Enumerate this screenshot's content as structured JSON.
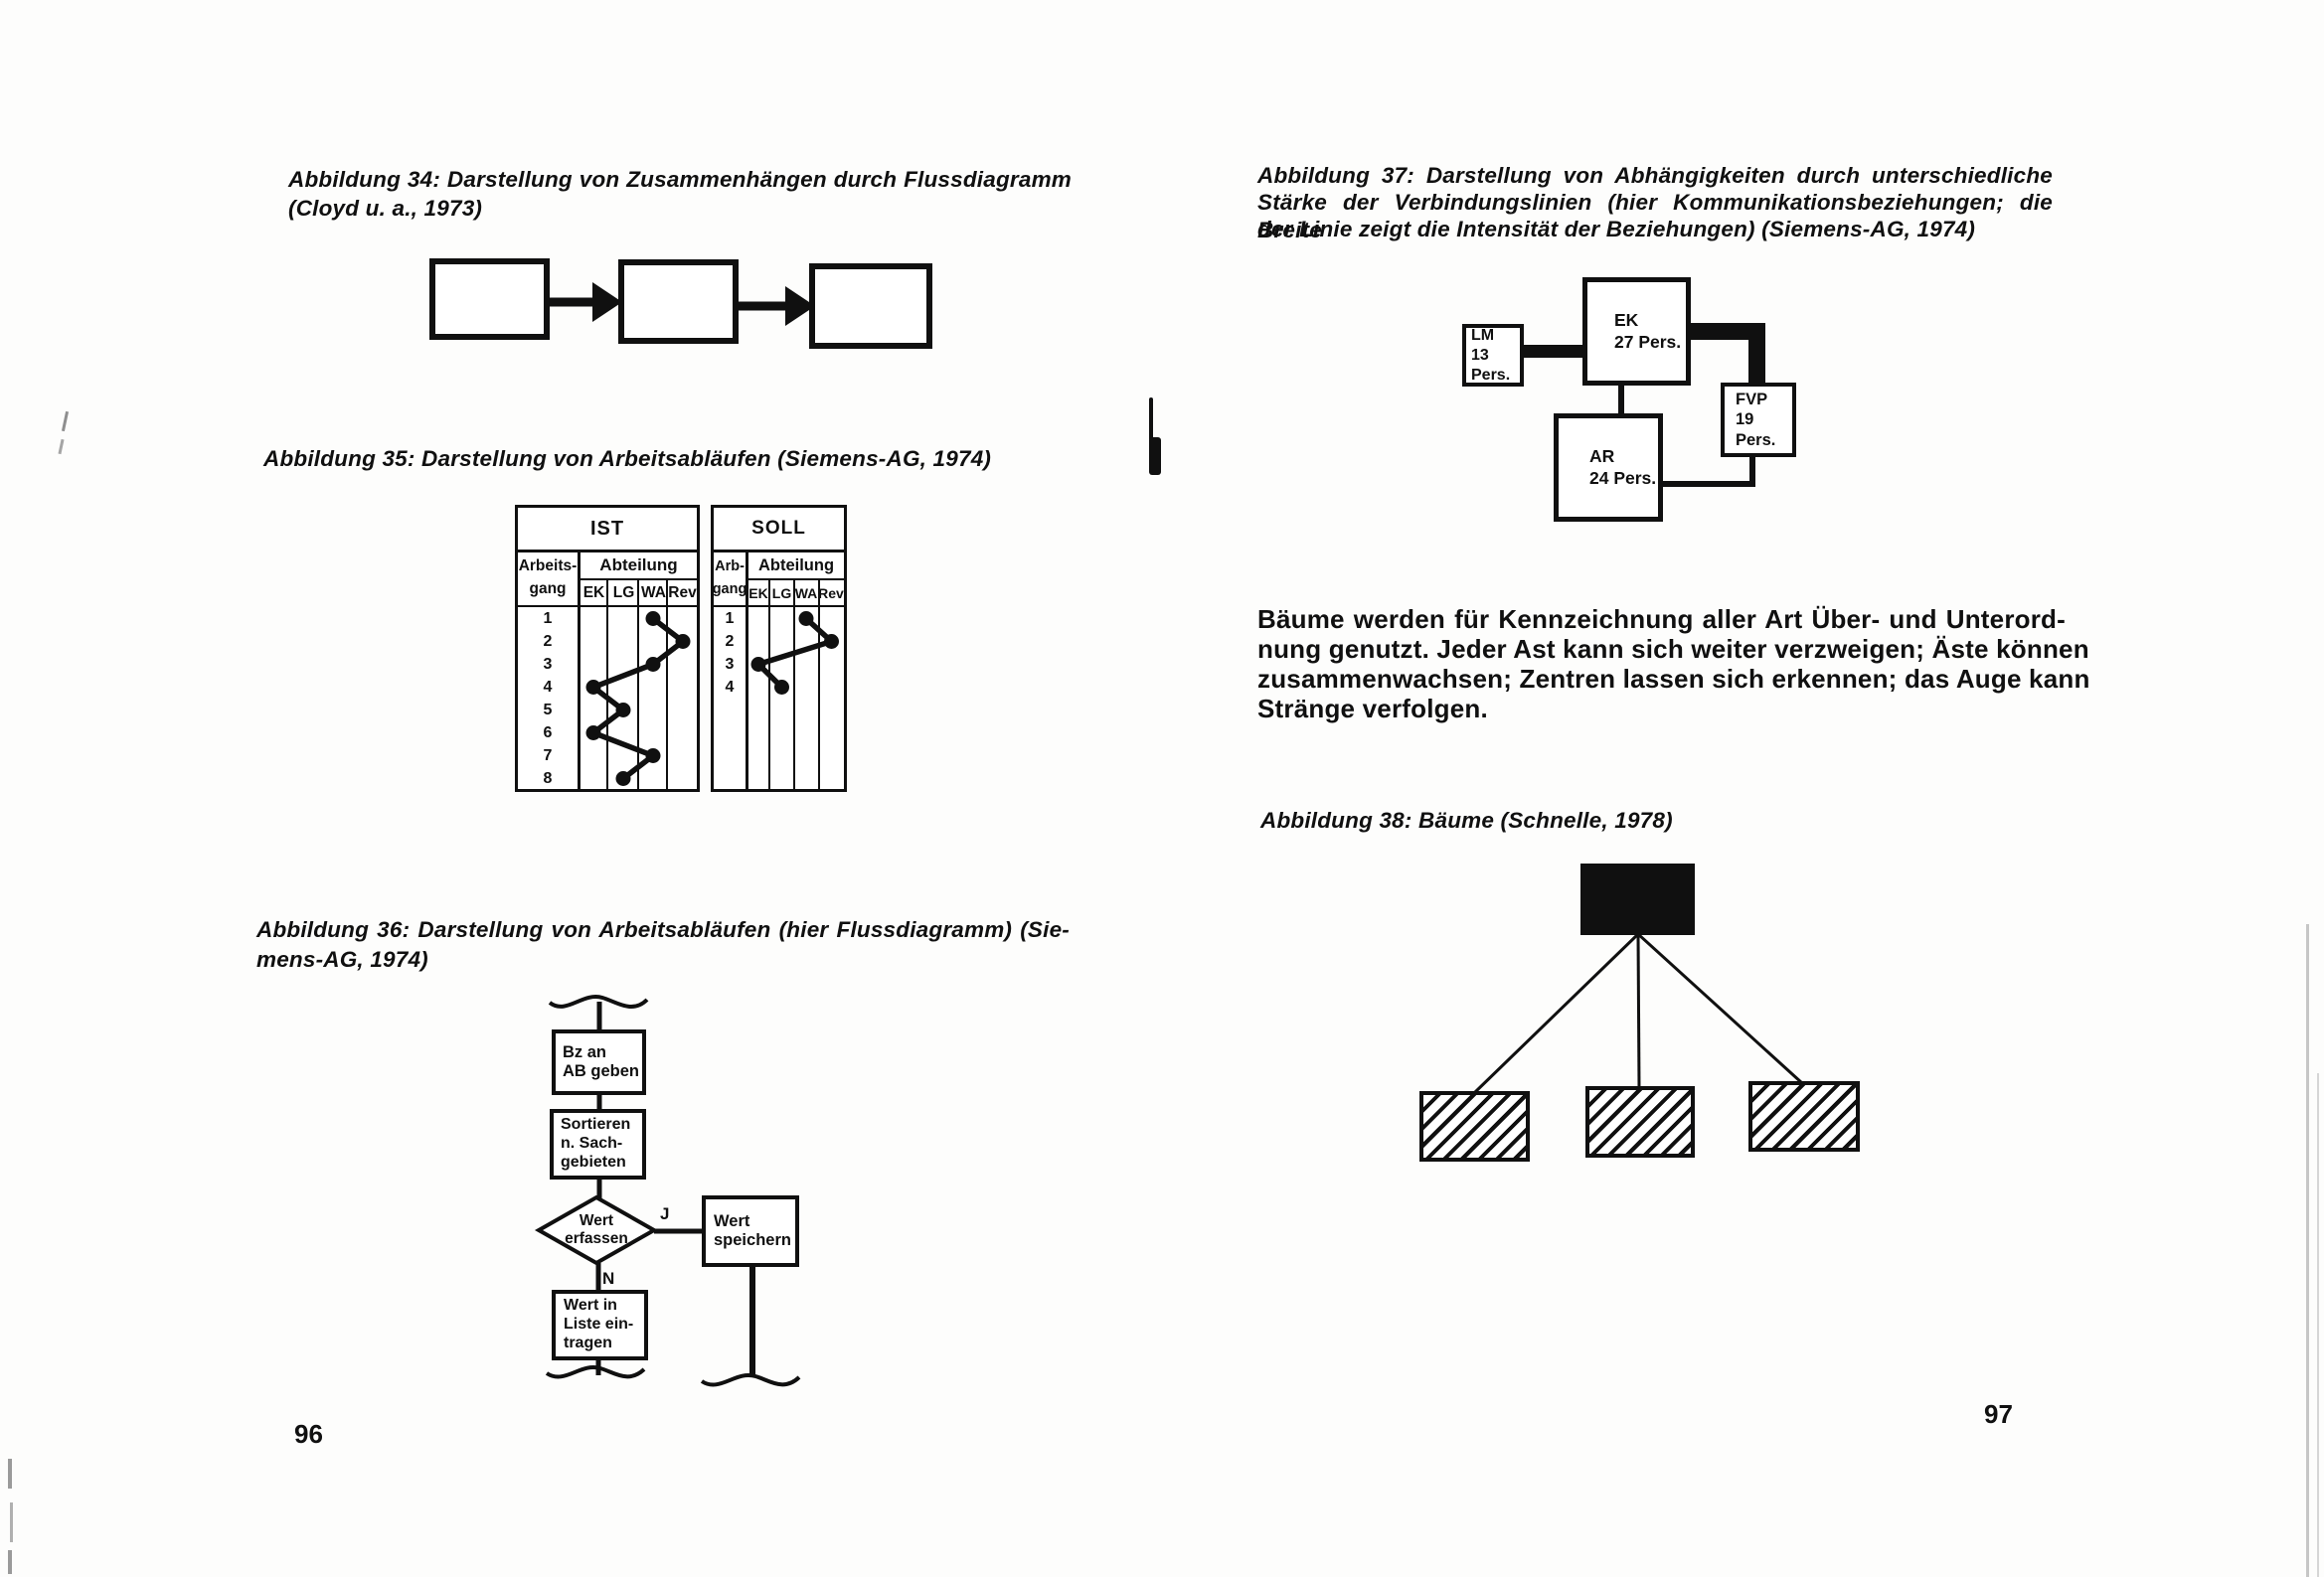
{
  "ink": "#101010",
  "paper": "#fdfdfc",
  "left_page": {
    "page_number": "96",
    "fig34": {
      "caption_line1": "Abbildung 34: Darstellung von Zusammenhängen durch Flussdiagramm",
      "caption_line2": "(Cloyd u. a., 1973)"
    },
    "fig35": {
      "caption": "Abbildung 35: Darstellung von Arbeitsabläufen (Siemens-AG, 1974)",
      "ist": {
        "title": "IST",
        "row_header_line1": "Arbeits-",
        "row_header_line2": "gang",
        "group_header": "Abteilung",
        "columns": [
          "EK",
          "LG",
          "WA",
          "Rev"
        ],
        "rows": [
          "1",
          "2",
          "3",
          "4",
          "5",
          "6",
          "7",
          "8"
        ],
        "flow_by_row": [
          "WA",
          "Rev",
          "WA",
          "EK",
          "LG",
          "EK",
          "WA",
          "LG"
        ]
      },
      "soll": {
        "title": "SOLL",
        "row_header_line1": "Arb-",
        "row_header_line2": "gang",
        "group_header": "Abteilung",
        "columns": [
          "EK",
          "LG",
          "WA",
          "Rev"
        ],
        "rows": [
          "1",
          "2",
          "3",
          "4"
        ],
        "flow_by_row": [
          "WA",
          "Rev",
          "EK",
          "LG"
        ]
      }
    },
    "fig36": {
      "caption_line1": "Abbildung 36: Darstellung von Arbeitsabläufen (hier Flussdiagramm) (Sie-",
      "caption_line2": "mens-AG, 1974)",
      "flowchart": {
        "step1": "Bz an\nAB geben",
        "step2": "Sortieren\nn. Sach-\ngebieten",
        "decision": "Wert\nerfassen",
        "yes_label": "J",
        "no_label": "N",
        "yes_step": "Wert\nspeichern",
        "no_step": "Wert in\nListe ein-\ntragen"
      }
    }
  },
  "right_page": {
    "page_number": "97",
    "fig37": {
      "caption_line1": "Abbildung 37: Darstellung von Abhängigkeiten durch unterschiedliche",
      "caption_line2": "Stärke der Verbindungslinien (hier Kommunikationsbeziehungen; die Breite",
      "caption_line3": "der Linie zeigt die Intensität der Beziehungen) (Siemens-AG, 1974)",
      "nodes": {
        "lm": "LM\n13 Pers.",
        "ek": "EK\n27 Pers.",
        "fvp": "FVP\n19 Pers.",
        "ar": "AR\n24 Pers."
      }
    },
    "body_lines": [
      "Bäume werden für Kennzeichnung aller Art Über- und Unterord-",
      "nung genutzt. Jeder Ast kann sich weiter verzweigen; Äste können",
      "zusammenwachsen; Zentren lassen sich erkennen; das Auge kann",
      "Stränge verfolgen."
    ],
    "fig38": {
      "caption": "Abbildung 38: Bäume (Schnelle, 1978)"
    }
  }
}
